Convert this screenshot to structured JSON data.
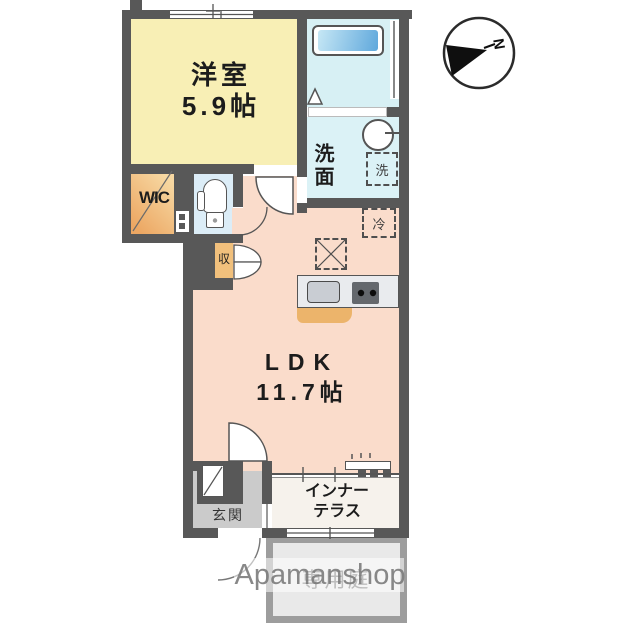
{
  "plan_title": "1LDK apartment floor plan",
  "rooms": {
    "western": {
      "name": "洋室",
      "size": "5.9帖"
    },
    "ldk": {
      "name": "LDK",
      "size": "11.7帖"
    },
    "wic": {
      "label": "WIC"
    },
    "washroom": {
      "label": "洗面"
    },
    "entrance": {
      "label": "玄関"
    },
    "terrace": {
      "line1": "インナー",
      "line2": "テラス"
    },
    "garden": {
      "label": "専用庭"
    }
  },
  "fixtures": {
    "washer": "洗",
    "fridge": "冷",
    "storage": "収"
  },
  "compass": {
    "north": "N"
  },
  "watermark": {
    "text": "Apamanshop"
  },
  "colors": {
    "wall": "#585858",
    "western_room_fill": "#f8efb5",
    "ldk_fill": "#fadccb",
    "bath_fill": "#d7f0f4",
    "washroom_fill": "#dbf2f6",
    "toilet_fill": "#dcedf7",
    "wic_fill": "#eca763",
    "storage_fill": "#f1c07c",
    "entrance_fill": "#cbcbcb",
    "terrace_fill": "#f6f2ec",
    "garden_fill": "#e9e9e9",
    "garden_border": "#9d9d9d",
    "tub_fill": "#5fa8dc",
    "kitchen_counter": "#e9ebee",
    "kitchen_cabinet": "#ecb46b"
  }
}
